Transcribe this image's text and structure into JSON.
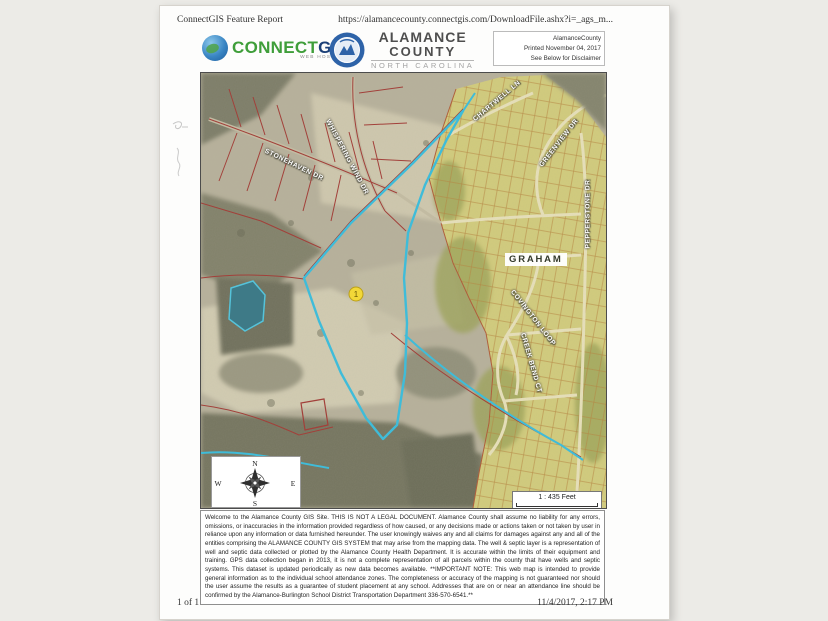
{
  "print_header": {
    "title": "ConnectGIS Feature Report",
    "url": "https://alamancecounty.connectgis.com/DownloadFile.ashx?i=_ags_m..."
  },
  "header": {
    "connectgis": {
      "connect": "CONNECT",
      "gis": "GIS",
      "tagline": "WEB HOSTING"
    },
    "county": {
      "line1": "ALAMANCE",
      "line2": "COUNTY",
      "line3": "NORTH CAROLINA"
    },
    "print_info": {
      "account": "AlamanceCounty",
      "printed": "Printed November 04, 2017",
      "note": "See Below for Disclaimer"
    }
  },
  "map": {
    "city_label": "GRAHAM",
    "marker_label": "1",
    "street_labels": [
      {
        "name": "STONEHAVEN DR"
      },
      {
        "name": "WHISPERING WIND DR"
      },
      {
        "name": "CHARTWELL LN"
      },
      {
        "name": "GREENVIEW DR"
      },
      {
        "name": "PEPPERSTONE DR"
      },
      {
        "name": "COVINGTON LOOP"
      },
      {
        "name": "CREEK BEND CT"
      }
    ],
    "compass": {
      "n": "N",
      "s": "S",
      "e": "E",
      "w": "W"
    },
    "scale_text": "1 : 435 Feet",
    "colors": {
      "selection": "#3fbcd9",
      "parcel_line": "#a2403a",
      "subdivision": "#d2cc7c",
      "marker": "#f2d838"
    }
  },
  "disclaimer": {
    "text": "Welcome to the Alamance County GIS Site. THIS IS NOT A LEGAL DOCUMENT. Alamance County shall assume no liability for any errors, omissions, or inaccuracies in the information provided regardless of how caused, or any decisions made or actions taken or not taken by user in reliance upon any information or data furnished hereunder. The user knowingly waives any and all claims for damages against any and all of the entities comprising the ALAMANCE COUNTY GIS SYSTEM that may arise from the mapping data. The well & septic layer is a representation of well and septic data collected or plotted by the Alamance County Health Department. It is accurate within the limits of their equipment and training. GPS data collection began in 2013, it is not a complete representation of all parcels within the county that have wells and septic systems. This dataset is updated periodically as new data becomes available. **IMPORTANT NOTE: This web map is intended to provide general information as to the individual school attendance zones. The completeness or accuracy of the mapping is not guaranteed nor should the user assume the results as a guarantee of student placement at any school. Addresses that are on or near an attendance line should be confirmed by the Alamance-Burlington School District Transportation Department 336-570-6541.**"
  },
  "print_footer": {
    "page": "1 of 1",
    "datetime": "11/4/2017, 2:17 PM"
  }
}
